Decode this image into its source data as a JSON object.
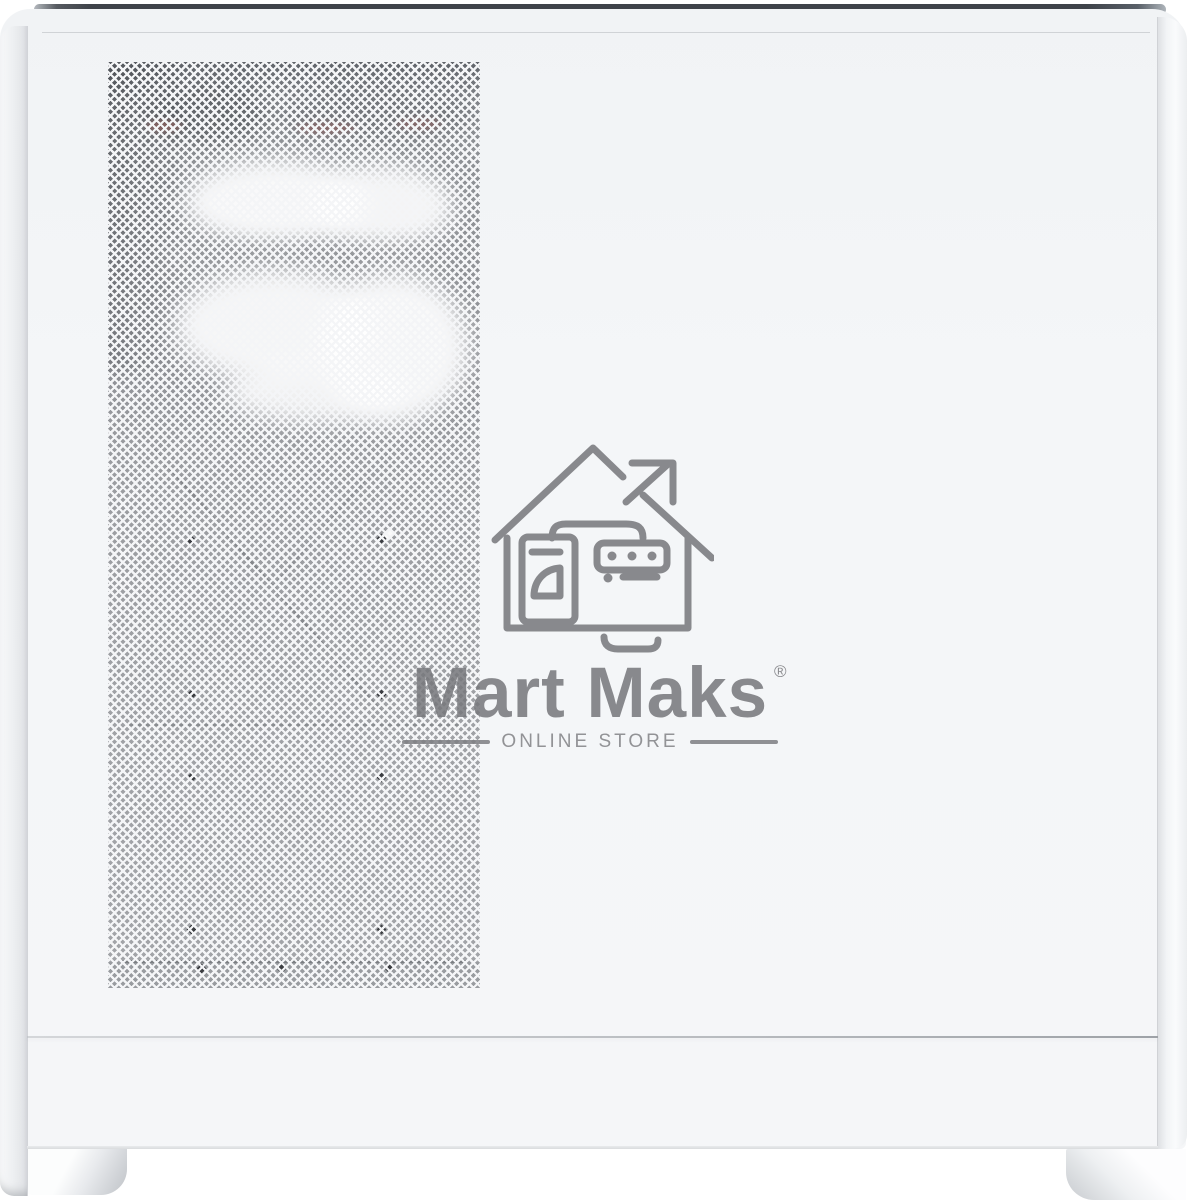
{
  "watermark": {
    "brand": "Mart Maks",
    "registered": "®",
    "tagline": "ONLINE STORE",
    "icon": "house-with-arrow-and-storefront",
    "color": "#77787c"
  },
  "colors": {
    "background": "#ffffff",
    "case_panel": "#f4f6f8",
    "top_strip": "#3f434a",
    "mesh_interior": "#9fa1a5",
    "mesh_lattice": "#f4f5f7",
    "seam": "#b9bcc0"
  }
}
